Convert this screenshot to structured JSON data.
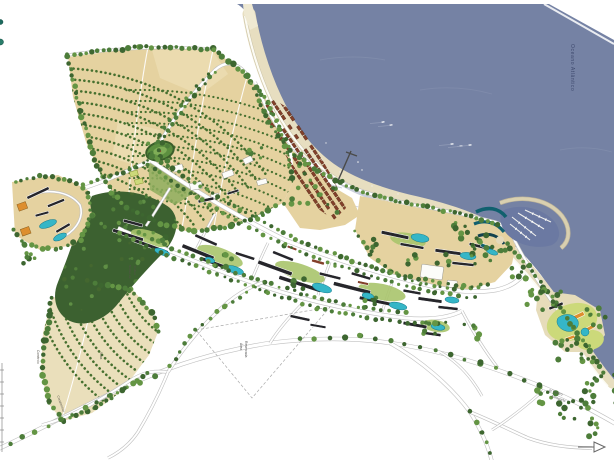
{
  "map": {
    "type": "coastal-resort-master-plan",
    "labels": {
      "ocean": "Oceano Atlântico",
      "villas": "Vilas",
      "commerce": "Comércio",
      "condominium": "Condomínio",
      "nucleus": [
        "Núcleo de",
        "Cultivo"
      ],
      "reserved": [
        "Área",
        "Reservada"
      ],
      "road_dir": [
        "p/ Centro",
        "Aeroporto"
      ]
    },
    "colors": {
      "ocean": "#7582a4",
      "harbor_water": "#6b79a2",
      "shallow_water": "#8b96b3",
      "beach_sand": "#e7dec0",
      "breakwater": "#d9d0b0",
      "boardwalk": "#fcfbf4",
      "field_dark": "#e5d2a0",
      "field_light": "#eadfbb",
      "tree_row": "#46702f",
      "forest": "#3c6130",
      "building_roof": "#26262b",
      "building_white": "#fcfcf9",
      "red_roof": "#82402a",
      "pool": "#35b6c7",
      "lawn": "#a9c46c",
      "lawn_bright": "#ccd97a",
      "road": "#ffffff",
      "road_casing": "#bfbfbf",
      "marina_teal": "#10606e",
      "orange_building": "#dd8e2e",
      "tree_palette": [
        "#3d6630",
        "#4d7d3a",
        "#649544"
      ]
    }
  }
}
